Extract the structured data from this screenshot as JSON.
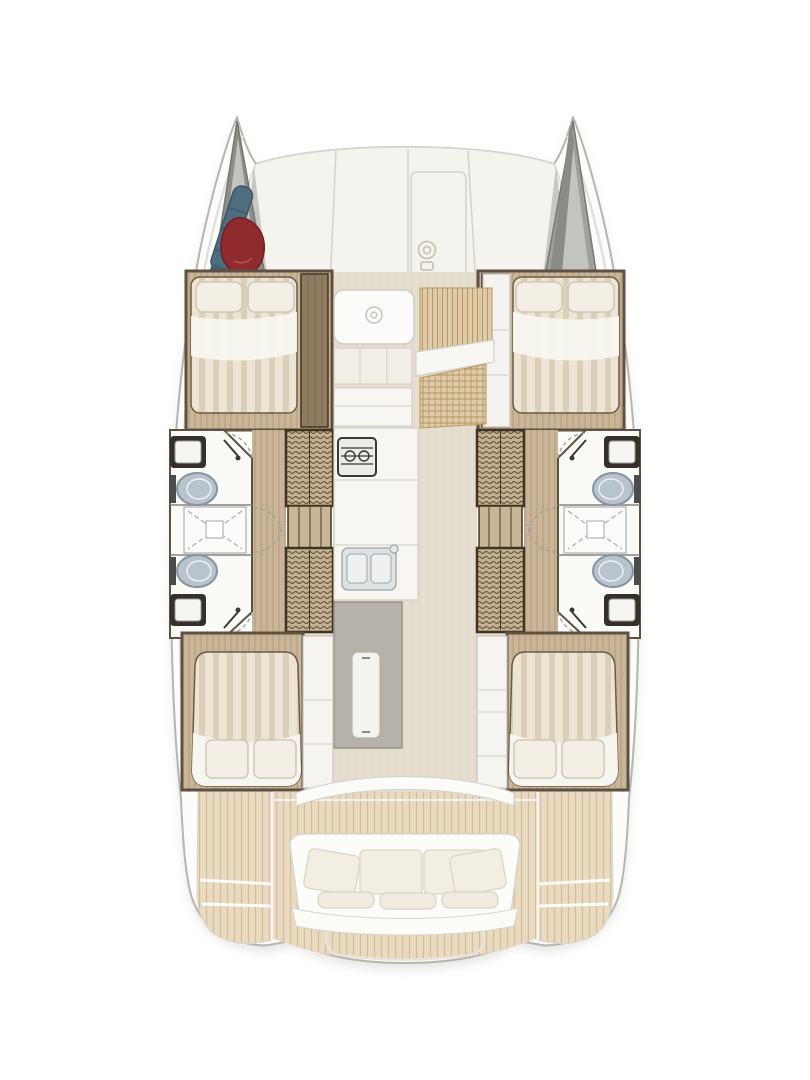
{
  "title": "catamaran-deck-plan",
  "palette": {
    "hull": "#fcfcfa",
    "hullEdge": "#b5b5b1",
    "hullInner": "#e0e0dd",
    "shadow": "#cfcfcb",
    "band": "#f5f3ee",
    "seam": "#d5d2ca",
    "lockerDark": "#8d8d89",
    "lockerMid": "#a0a09c",
    "lockerLight": "#c3c3bf",
    "sailBlue": "#4e6d80",
    "sailBlueDark": "#3c5766",
    "gennakerRed": "#8f2b2d",
    "gennakerDark": "#6e2023",
    "wood": "#c9b698",
    "woodLine": "#b39b77",
    "ward": "#c2b192",
    "wardLine": "#5f4e33",
    "wardFrame": "#3f3421",
    "wallDark": "#5f5140",
    "panelWood": "#8d7c60",
    "bedCream": "#ece4d4",
    "bedStripe": "#dccfb8",
    "bedEdge": "#6b5b44",
    "sheetWhite": "#f7f5ef",
    "pillow": "#f3efe5",
    "pillowLine": "#cfc8b8",
    "bathFloor": "#fafaf7",
    "bathLine": "#8a8178",
    "fixtureFrame": "#35302a",
    "fixtureWhite": "#f4f4f2",
    "toilet": "#b7c3cd",
    "toiletLine": "#8494a1",
    "dash": "#9aa0a2",
    "salonFloor": "#e5ddcd",
    "salonLine": "#d9d0bd",
    "hatchFill": "#ddcbaa",
    "hatchLine": "#b8975f",
    "counter": "#f7f6f2",
    "counterLine": "#c9c6be",
    "stoveDark": "#3a3832",
    "steel": "#dfe2e2",
    "steelLine": "#9aa5a5",
    "island": "#b6b2aa",
    "islandLine": "#97938b",
    "teak": "#e9dac0",
    "teakLine": "#d2bd9c",
    "deckWhite": "#f4f2ec",
    "bench": "#fcfcfa",
    "benchLine": "#d8d5cd",
    "cushion": "#f3eee2",
    "cushionLine": "#ddd5c3"
  },
  "icons": [
    "windlass-icon",
    "shower-head-icon",
    "faucet-icon",
    "drain-icon"
  ],
  "areas": [
    "port-bow-locker",
    "starboard-bow-locker",
    "foredeck-lounge",
    "forward-cabin-port",
    "forward-cabin-starboard",
    "head-port",
    "head-starboard",
    "shower-port",
    "shower-starboard",
    "wardrobe-port",
    "wardrobe-starboard",
    "companionway-stairs",
    "saloon",
    "nav-table",
    "dinette",
    "galley",
    "galley-island",
    "aft-cabin-port",
    "aft-cabin-starboard",
    "cockpit",
    "cockpit-bench",
    "swim-platform-port",
    "swim-platform-starboard",
    "aft-platform"
  ],
  "stored_gear": [
    "sail-bag",
    "gennaker"
  ]
}
